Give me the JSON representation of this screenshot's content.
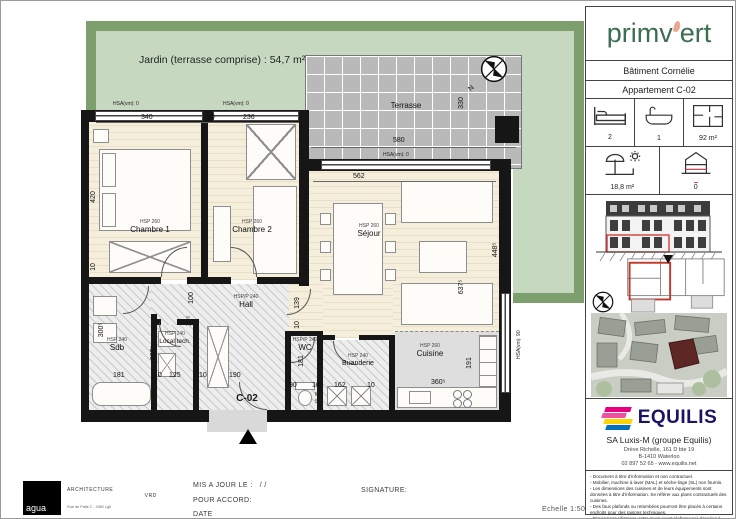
{
  "sheet": {
    "scale": "Echelle 1:50",
    "updated_label": "MIS A JOUR LE :",
    "updated_value": "/        /",
    "accord_label": "POUR ACCORD:",
    "date_label": "DATE",
    "signature_label": "SIGNATURE:",
    "architect": {
      "logo": "agua",
      "line1": "ARCHITECTURE",
      "line2": "VRD",
      "line3": "Rue de Palle 2 - 1380 Lgh"
    }
  },
  "plan": {
    "garden_label": "Jardin (terrasse comprise) : 54,7 m²",
    "entrance_label": "C-02",
    "north": "N",
    "ml": "ML",
    "sl": "SL",
    "rooms": [
      {
        "label": "Chambre 1",
        "hsp": "HSP 260"
      },
      {
        "label": "Chambre 2",
        "hsp": "HSP 260"
      },
      {
        "label": "Séjour",
        "hsp": "HSP 260"
      },
      {
        "label": "Hall",
        "hsp": "HSP/P 240"
      },
      {
        "label": "Sdb",
        "hsp": "HSP 240"
      },
      {
        "label": "Local tech.",
        "hsp": "HSP 240"
      },
      {
        "label": "WC",
        "hsp": "HSP/P 240"
      },
      {
        "label": "Buanderie",
        "hsp": "HSP 240"
      },
      {
        "label": "Cuisine",
        "hsp": "HSP 260"
      },
      {
        "label": "Terrasse",
        "hsp": ""
      }
    ],
    "dims": [
      "340",
      "10",
      "236",
      "420",
      "10",
      "562",
      "448⁵",
      "637⁵",
      "191",
      "580",
      "330",
      "300⁵",
      "181",
      "10",
      "125",
      "10",
      "190",
      "90",
      "10",
      "162",
      "10",
      "360⁵",
      "100",
      "10⁵",
      "227⁵",
      "139",
      "10",
      "181"
    ],
    "hsa": [
      "HSA(vm): 0",
      "HSA(vm): 0",
      "HSA(vm): 0",
      "HSA(vm): 90"
    ]
  },
  "sidebar": {
    "brand_left": "primv",
    "brand_right": "ert",
    "building": "Bâtiment Cornélie",
    "apartment": "Appartement C-02",
    "stats": {
      "bedrooms": "2",
      "bathrooms": "1",
      "area": "92 m²",
      "terrace": "18,8 m²",
      "level": "0"
    },
    "company": {
      "name": "EQUILIS",
      "entity": "SA Luxis-M (groupe Equilis)",
      "addr1": "Drève Richelle, 161 D bte 19",
      "addr2": "B-1410 Waterloo",
      "addr3": "02 897 52 65 - www.equilis.net"
    },
    "notes": [
      "- Document à titre d'information et non contractuel.",
      "- Mobilier, machine à laver (MAL) et sèche-linge (SL) non fournis.",
      "- Les dimensions des cuisines et de leurs équipements sont données à titre d'information. Se référer aux plans contractuels des cuisines.",
      "- Des faux plafonds ou retombées pourront être placés à certains endroits pour des raisons techniques.",
      "- Dimensions (distance entre murs avant plafonnage) données à titre indicatif."
    ]
  },
  "colors": {
    "brand_green": "#3c6e52",
    "leaf_salmon": "#e8a78f",
    "equilis_magenta": "#e5007d",
    "equilis_yellow": "#ffd400",
    "equilis_blue": "#0072bc",
    "highlight_red": "#e0474c",
    "garden_light": "#c6d9c0",
    "garden_dark": "#7d9f6e"
  }
}
